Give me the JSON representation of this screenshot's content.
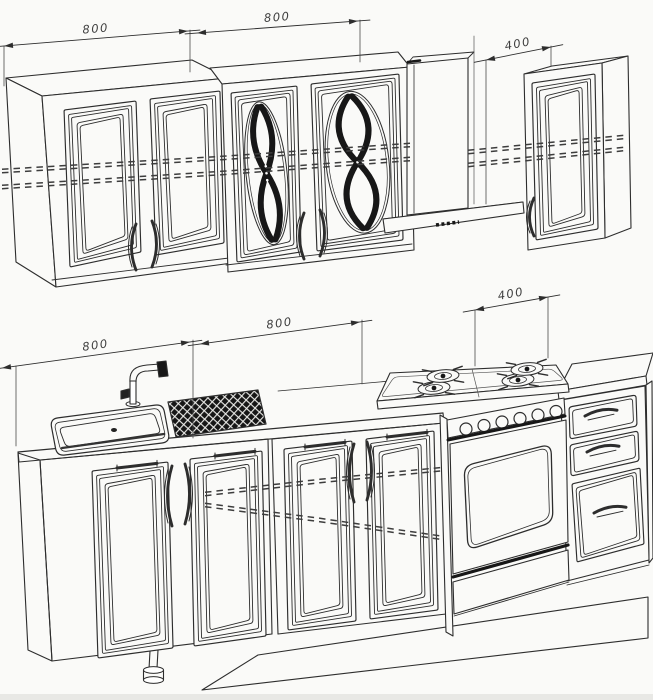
{
  "page": {
    "title": "Kitchen set dimensional line drawing"
  },
  "drawing": {
    "background_color": "#fafaf8",
    "line_color": "#2d2d2d",
    "dark_accent_color": "#171717",
    "hidden_line_color": "#3d3d3d",
    "dimensions": {
      "wall_row": [
        {
          "label": "800"
        },
        {
          "label": "800"
        },
        {
          "label": "400"
        }
      ],
      "base_row": [
        {
          "label": "800"
        },
        {
          "label": "800"
        },
        {
          "label": "400"
        }
      ]
    }
  }
}
